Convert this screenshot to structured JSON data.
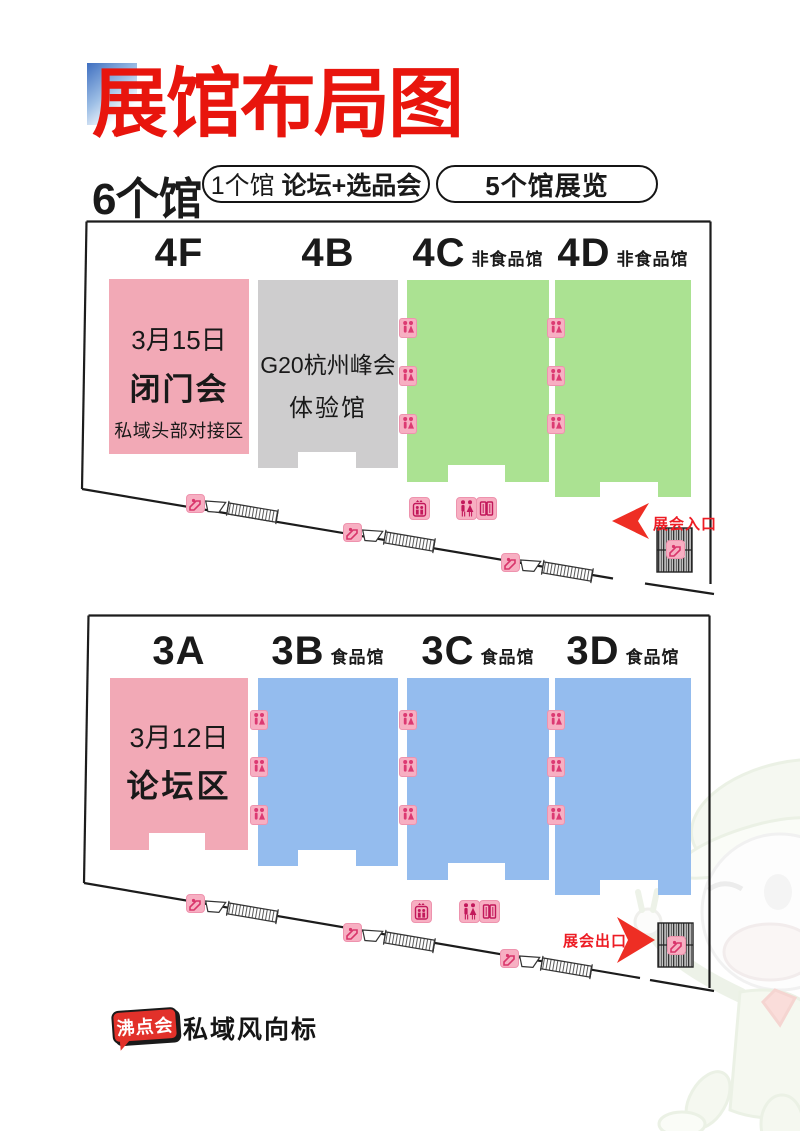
{
  "page": {
    "title": "展馆布局图"
  },
  "summary": {
    "total": "6个馆",
    "pill1_prefix": "1个馆",
    "pill1_main": "论坛+选品会",
    "pill2": "5个馆展览"
  },
  "upper_map": {
    "halls": [
      {
        "id": "4F",
        "tag": ""
      },
      {
        "id": "4B",
        "tag": ""
      },
      {
        "id": "4C",
        "tag": "非食品馆"
      },
      {
        "id": "4D",
        "tag": "非食品馆"
      }
    ],
    "hall_4f": {
      "date": "3月15日",
      "title": "闭门会",
      "sub": "私域头部对接区"
    },
    "hall_4b": {
      "line1": "G20杭州峰会",
      "line2": "体验馆"
    },
    "entrance_label": "展会入口"
  },
  "lower_map": {
    "halls": [
      {
        "id": "3A",
        "tag": ""
      },
      {
        "id": "3B",
        "tag": "食品馆"
      },
      {
        "id": "3C",
        "tag": "食品馆"
      },
      {
        "id": "3D",
        "tag": "食品馆"
      }
    ],
    "hall_3a": {
      "date": "3月12日",
      "title": "论坛区"
    },
    "exit_label": "展会出口"
  },
  "footer": {
    "badge": "沸点会",
    "brand": "私域风向标"
  },
  "colors": {
    "accent_red": "#E8150D",
    "arrow_red": "#EE2E24",
    "forum_pink": "#F2A9B6",
    "experience_gray": "#CECDCE",
    "nonfood_green": "#ABE292",
    "food_blue": "#94BCEE",
    "icon_pink_bg": "#F7AFC2",
    "icon_pink_glyph": "#DC3A72"
  }
}
